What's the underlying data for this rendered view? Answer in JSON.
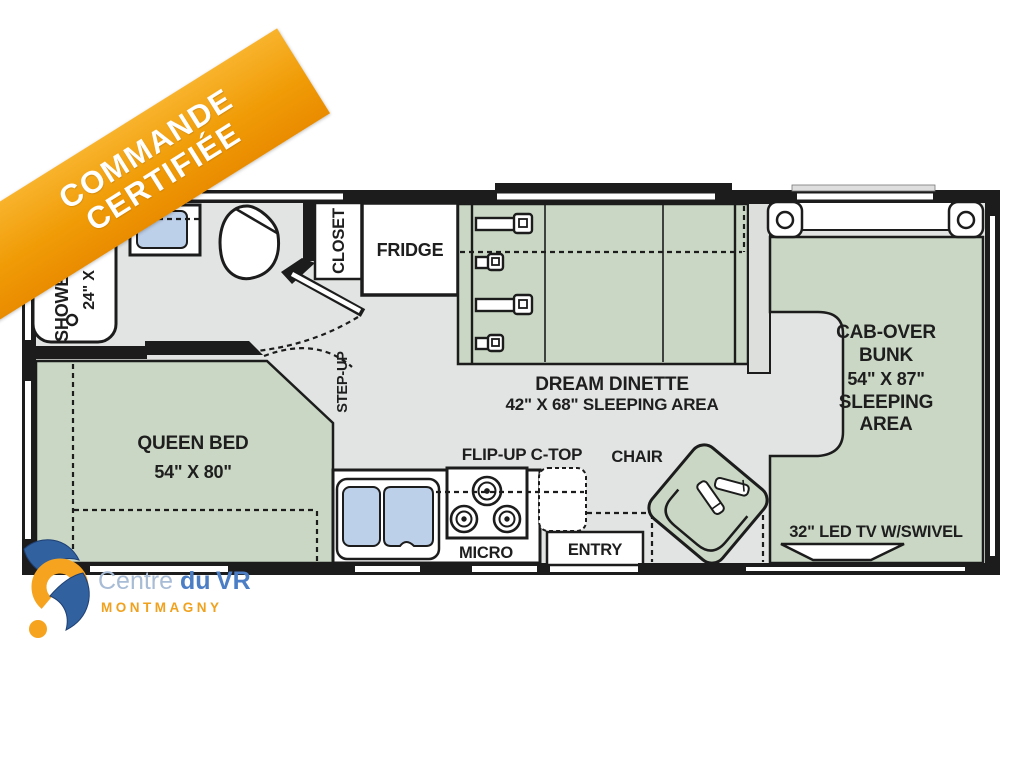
{
  "banner": {
    "line1": "COMMANDE",
    "line2": "CERTIFIÉE"
  },
  "floorplan": {
    "labels": {
      "shower": "SHOWER",
      "shower_dim": "24\" X",
      "closet": "CLOSET",
      "fridge": "FRIDGE",
      "step_up": "STEP-UP",
      "dinette_name": "DREAM DINETTE",
      "dinette_dim": "42\" X 68\" SLEEPING AREA",
      "queen_name": "QUEEN BED",
      "queen_dim": "54\" X 80\"",
      "cabover_1": "CAB-OVER",
      "cabover_2": "BUNK",
      "cabover_3": "54\" X 87\"",
      "cabover_4": "SLEEPING",
      "cabover_5": "AREA",
      "flip_up": "FLIP-UP C-TOP",
      "chair": "CHAIR",
      "micro": "MICRO",
      "entry": "ENTRY",
      "tv": "32\" LED TV W/SWIVEL"
    },
    "colors": {
      "furniture_green": "#c9d7c4",
      "floor_gray": "#e1e4e2",
      "wall_black": "#1c1c1c",
      "sink_blue": "#bdd0e9",
      "banner_orange": "#f09c07"
    }
  },
  "logo": {
    "name_1": "Centre",
    "name_2": "du",
    "name_3": "VR",
    "city": "MONTMAGNY"
  }
}
